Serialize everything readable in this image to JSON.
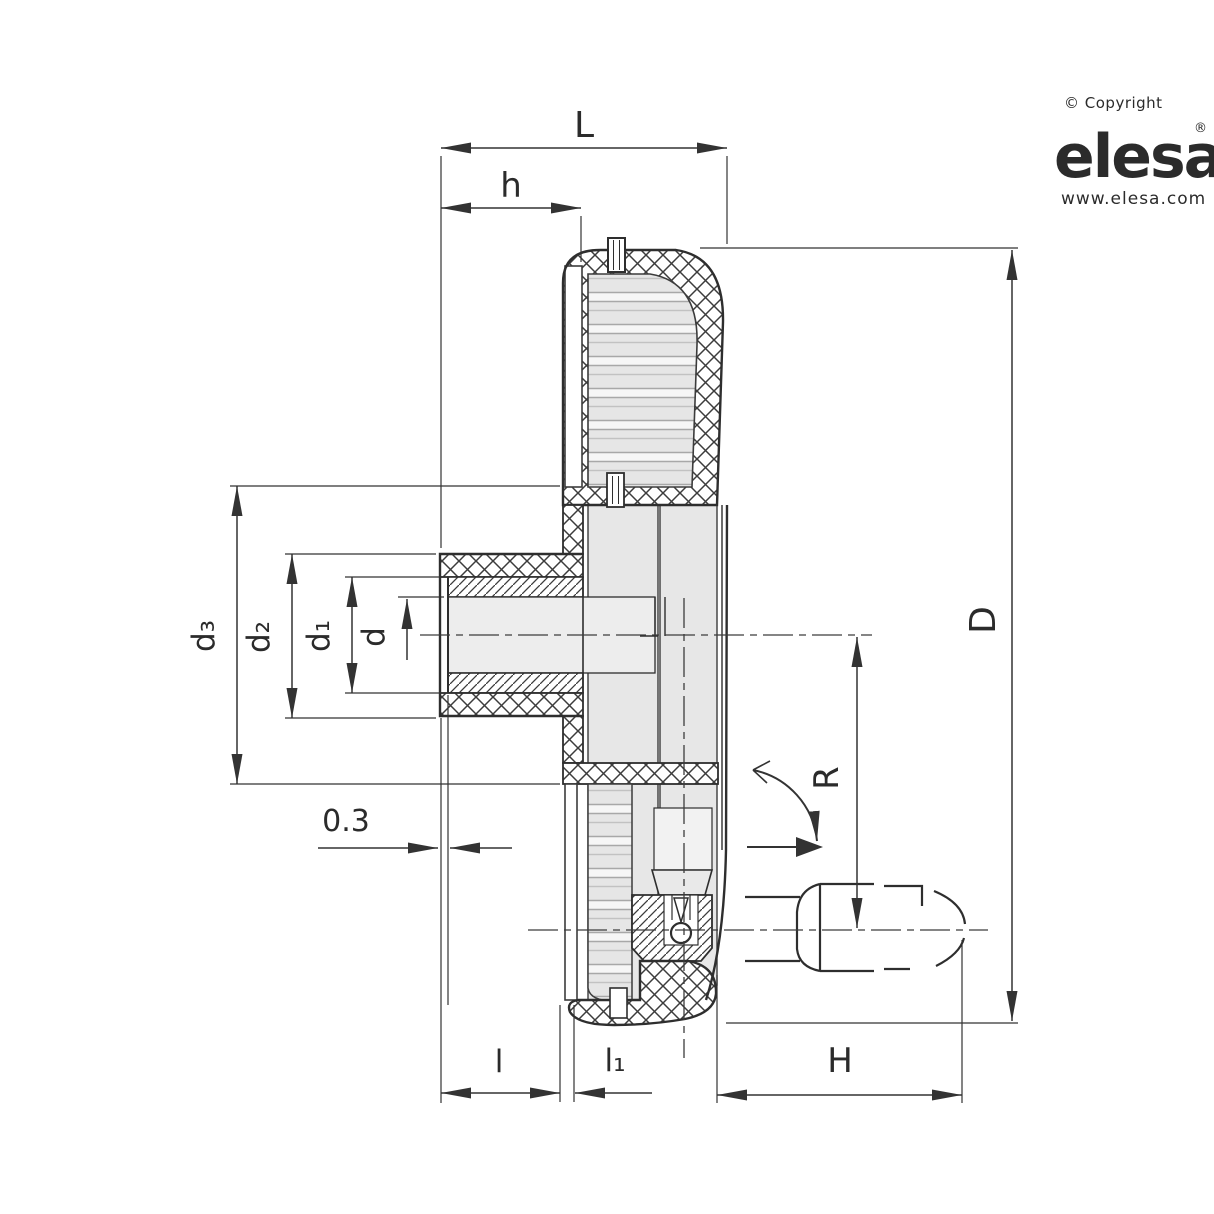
{
  "branding": {
    "copyright": "© Copyright",
    "logo_text": "elesa",
    "registered_mark": "®",
    "website": "www.elesa.com"
  },
  "dimensions": {
    "L": "L",
    "h": "h",
    "d3": "d₃",
    "d2": "d₂",
    "d1": "d₁",
    "d": "d",
    "face_offset": "0.3",
    "l": "l",
    "l1": "l₁",
    "H": "H",
    "D": "D",
    "R": "R"
  },
  "colors": {
    "line": "#2e2e2e",
    "section_gray": "#e7e7e7",
    "logo_gray": "#c6c6ca"
  }
}
